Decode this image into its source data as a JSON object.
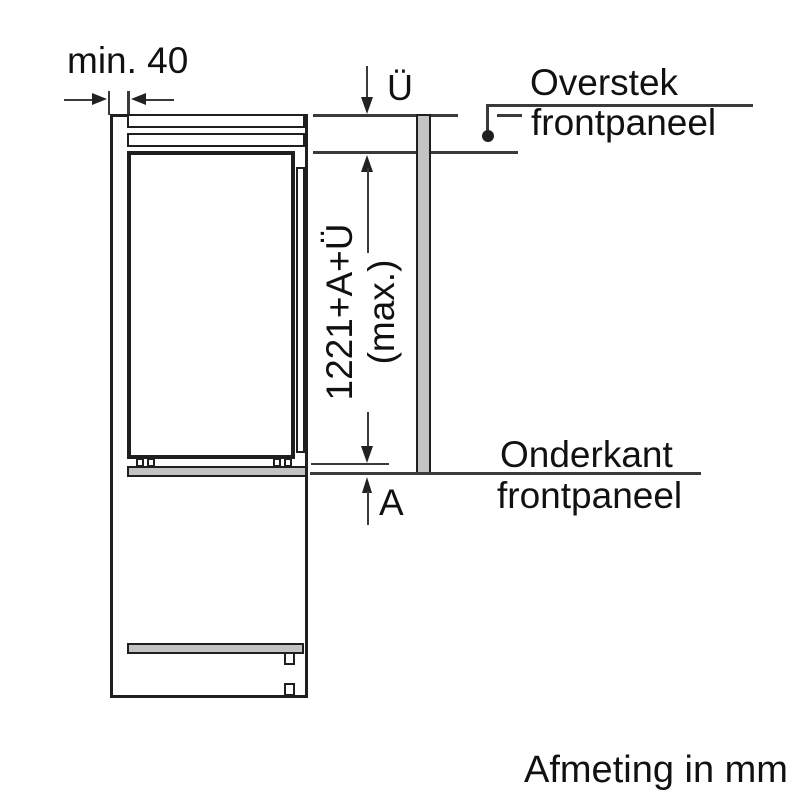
{
  "footer": {
    "units_note": "Afmeting in mm"
  },
  "dimensions": {
    "min_clearance": "min. 40",
    "overhang_symbol": "Ü",
    "total_height": "1221+A+Ü",
    "total_height_note": "(max.)",
    "bottom_gap_symbol": "A"
  },
  "callouts": {
    "top": {
      "line1": "Overstek",
      "line2": "frontpaneel"
    },
    "bottom": {
      "line1": "Onderkant",
      "line2": "frontpaneel"
    }
  },
  "colors": {
    "line": "#1f1f1f",
    "front_panel_fill": "#c3c3c3",
    "background": "#ffffff"
  }
}
